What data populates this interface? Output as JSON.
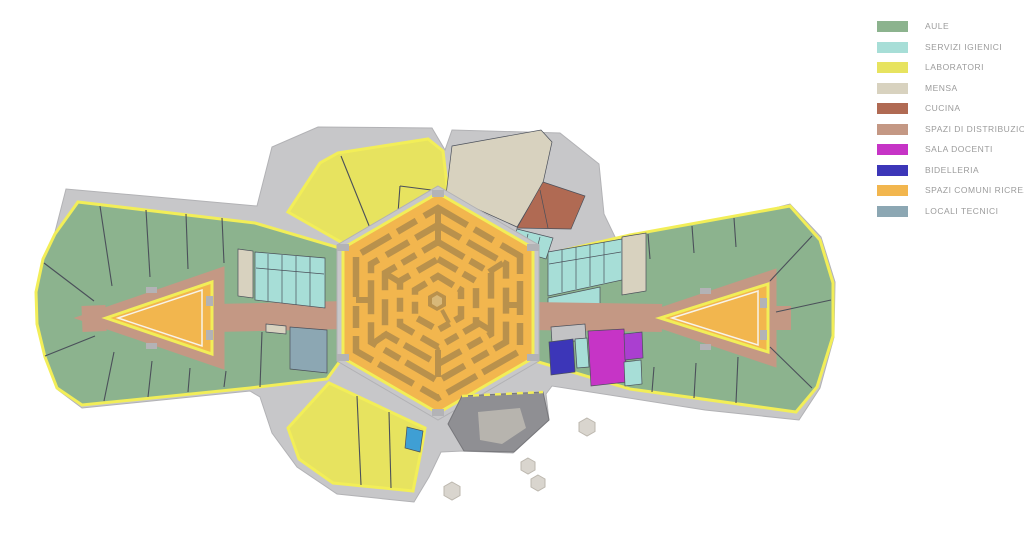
{
  "legend": {
    "items": [
      {
        "key": "aule",
        "label": "AULE",
        "color": "#8cb38e"
      },
      {
        "key": "servizi_igienici",
        "label": "SERVIZI IGIENICI",
        "color": "#a7ded7"
      },
      {
        "key": "laboratori",
        "label": "LABORATORI",
        "color": "#e7e35f"
      },
      {
        "key": "mensa",
        "label": "MENSA",
        "color": "#d8d2bf"
      },
      {
        "key": "cucina",
        "label": "CUCINA",
        "color": "#b06a53"
      },
      {
        "key": "spazi_di_distribuzione",
        "label": "SPAZI DI DISTRIBUZIONE",
        "color": "#c49884"
      },
      {
        "key": "sala_docenti",
        "label": "SALA DOCENTI",
        "color": "#c634c6"
      },
      {
        "key": "bidelleria",
        "label": "BIDELLERIA",
        "color": "#3c36b8"
      },
      {
        "key": "spazi_comuni_ricreativi",
        "label": "SPAZI COMUNI RICREATIVI",
        "color": "#f2b64e"
      },
      {
        "key": "locali_tecnici",
        "label": "LOCALI TECNICI",
        "color": "#8ca7b3"
      }
    ]
  },
  "palette": {
    "background": "#ffffff",
    "terrace": "#c7c7c9",
    "terrace_stroke": "#b2b2b5",
    "terrace_dark": "#8f8f93",
    "terrace_dark_inner": "#b7b4ae",
    "outline_yellow": "#f2ee58",
    "wall": "#4b505a",
    "maze": "#b9914c",
    "white_line": "#f7f3ea",
    "door_tab": "#b3b3b6",
    "gray_room": "#c3c3c5",
    "blue_room": "#3f9fd4",
    "purple_room": "#aa3fd0",
    "furniture": "#d9d5ce",
    "furniture_stroke": "#bcb7ae"
  }
}
